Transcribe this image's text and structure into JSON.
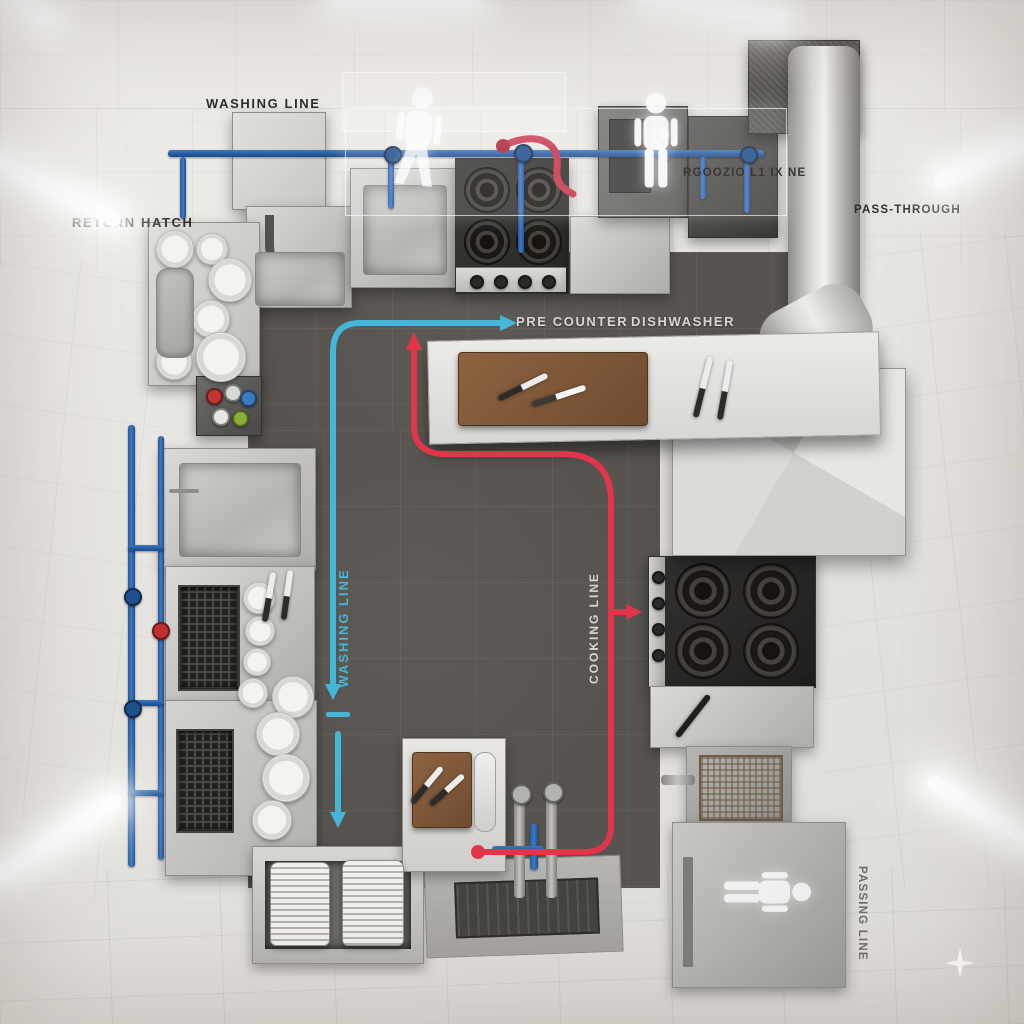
{
  "scene": {
    "description": "Top-down 3D rendered floor plan of a commercial kitchen with annotated work lines"
  },
  "labels": {
    "washing_line": "WASHING LINE",
    "return_hatch": "RETURN HATCH",
    "pre_counter": "PRE COUNTER",
    "dishwasher": "DISHWASHER",
    "goods_line": "RGOOZIO L1 IX NE",
    "pass_through": "PASS-THROUGH",
    "flow_washing_vertical": "WASHING LINE",
    "flow_cooking_vertical": "COOKING LINE",
    "passing_line": "PASSING LINE"
  },
  "colors": {
    "flow_washing": "#45b6d8",
    "flow_cooking": "#e33549",
    "pipes_water": "#2e68ae",
    "floor_dark": "#57544f",
    "wall_light": "#eceae5",
    "stainless": "#c2c1be",
    "label_dark": "#2e2c29",
    "label_light": "#d7d6d2"
  },
  "icons": {
    "person": "person-silhouette-icon",
    "sparkle": "sparkle-icon"
  },
  "equipment": [
    "pass-through hood",
    "dish conveyor",
    "return hatch plate table",
    "valve manifold",
    "wash sink",
    "dishwasher counter",
    "storage unit with vent",
    "plate rack",
    "prep station",
    "floor drain",
    "prep sink",
    "four-burner range (top wall)",
    "beverage machine",
    "upper cabinet",
    "extraction duct",
    "extraction hood",
    "pre counter island with cutting board",
    "four-burner range (right wall)",
    "fryer",
    "pass cabinet"
  ]
}
